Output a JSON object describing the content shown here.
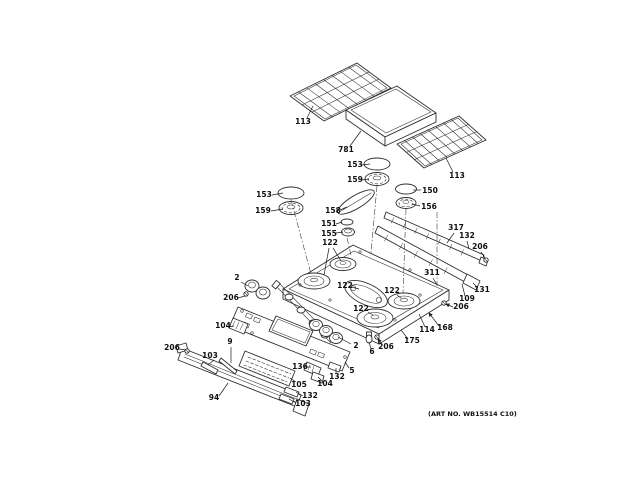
{
  "document": {
    "art_no": "(ART NO. WB15514 C10)",
    "background": "#ffffff",
    "line_color": "#2f2f2f",
    "label_color": "#101010"
  },
  "labels": [
    {
      "text": "113",
      "x": 303,
      "y": 124,
      "leaders": [
        [
          [
            307,
            118
          ],
          [
            313,
            106
          ]
        ]
      ]
    },
    {
      "text": "781",
      "x": 346,
      "y": 152,
      "leaders": [
        [
          [
            350,
            146
          ],
          [
            361,
            131
          ]
        ]
      ]
    },
    {
      "text": "113",
      "x": 457,
      "y": 178,
      "leaders": [
        [
          [
            453,
            172
          ],
          [
            446,
            158
          ]
        ]
      ]
    },
    {
      "text": "153",
      "x": 355,
      "y": 167,
      "leaders": [
        [
          [
            362,
            165
          ],
          [
            370,
            164
          ]
        ]
      ]
    },
    {
      "text": "159",
      "x": 355,
      "y": 182,
      "leaders": [
        [
          [
            362,
            180
          ],
          [
            369,
            179
          ]
        ]
      ]
    },
    {
      "text": "153",
      "x": 264,
      "y": 197,
      "leaders": [
        [
          [
            272,
            195
          ],
          [
            283,
            193
          ]
        ]
      ]
    },
    {
      "text": "159",
      "x": 263,
      "y": 213,
      "leaders": [
        [
          [
            271,
            211
          ],
          [
            283,
            209
          ]
        ]
      ]
    },
    {
      "text": "150",
      "x": 430,
      "y": 193,
      "leaders": [
        [
          [
            421,
            190
          ],
          [
            413,
            190
          ]
        ]
      ]
    },
    {
      "text": "156",
      "x": 429,
      "y": 209,
      "leaders": [
        [
          [
            420,
            206
          ],
          [
            412,
            204
          ]
        ]
      ]
    },
    {
      "text": "158",
      "x": 333,
      "y": 213,
      "leaders": [
        [
          [
            340,
            210
          ],
          [
            347,
            207
          ]
        ]
      ]
    },
    {
      "text": "151",
      "x": 329,
      "y": 226,
      "leaders": [
        [
          [
            336,
            224
          ],
          [
            342,
            222
          ]
        ]
      ]
    },
    {
      "text": "155",
      "x": 329,
      "y": 236,
      "leaders": [
        [
          [
            336,
            233
          ],
          [
            343,
            232
          ]
        ]
      ]
    },
    {
      "text": "122",
      "x": 330,
      "y": 245,
      "leaders": [
        [
          [
            333,
            248
          ],
          [
            341,
            261
          ]
        ],
        [
          [
            329,
            248
          ],
          [
            324,
            275
          ]
        ]
      ]
    },
    {
      "text": "317",
      "x": 456,
      "y": 230,
      "leaders": [
        [
          [
            454,
            233
          ],
          [
            447,
            243
          ]
        ]
      ]
    },
    {
      "text": "132",
      "x": 467,
      "y": 238,
      "leaders": [
        [
          [
            467,
            241
          ],
          [
            469,
            249
          ]
        ]
      ]
    },
    {
      "text": "206",
      "x": 480,
      "y": 249,
      "leaders": [
        [
          [
            481,
            252
          ],
          [
            485,
            258
          ]
        ]
      ]
    },
    {
      "text": "311",
      "x": 432,
      "y": 275,
      "leaders": [
        [
          [
            433,
            278
          ],
          [
            437,
            285
          ]
        ]
      ]
    },
    {
      "text": "131",
      "x": 482,
      "y": 292,
      "leaders": [
        [
          [
            478,
            288
          ],
          [
            473,
            283
          ]
        ]
      ]
    },
    {
      "text": "109",
      "x": 467,
      "y": 301,
      "leaders": [
        [
          [
            465,
            296
          ],
          [
            462,
            284
          ]
        ]
      ]
    },
    {
      "text": "206",
      "x": 461,
      "y": 309,
      "arrow": true,
      "leaders": [
        [
          [
            453,
            307
          ],
          [
            446,
            304
          ]
        ]
      ]
    },
    {
      "text": "168",
      "x": 445,
      "y": 330,
      "arrow": true,
      "leaders": [
        [
          [
            439,
            326
          ],
          [
            429,
            313
          ]
        ]
      ]
    },
    {
      "text": "114",
      "x": 427,
      "y": 332,
      "leaders": [
        [
          [
            425,
            327
          ],
          [
            419,
            314
          ]
        ]
      ]
    },
    {
      "text": "175",
      "x": 412,
      "y": 343,
      "leaders": [
        [
          [
            408,
            339
          ],
          [
            401,
            330
          ]
        ]
      ]
    },
    {
      "text": "122",
      "x": 345,
      "y": 288,
      "leaders": [
        [
          [
            352,
            287
          ],
          [
            359,
            289
          ]
        ]
      ]
    },
    {
      "text": "122",
      "x": 392,
      "y": 293,
      "leaders": [
        [
          [
            397,
            295
          ],
          [
            401,
            298
          ]
        ]
      ]
    },
    {
      "text": "122",
      "x": 361,
      "y": 311,
      "leaders": [
        [
          [
            368,
            312
          ],
          [
            373,
            315
          ]
        ]
      ]
    },
    {
      "text": "2",
      "x": 237,
      "y": 280,
      "leaders": [
        [
          [
            241,
            282
          ],
          [
            248,
            286
          ]
        ]
      ]
    },
    {
      "text": "206",
      "x": 231,
      "y": 300,
      "leaders": [
        [
          [
            238,
            298
          ],
          [
            245,
            296
          ]
        ]
      ]
    },
    {
      "text": "104",
      "x": 223,
      "y": 328,
      "leaders": [
        [
          [
            229,
            327
          ],
          [
            234,
            326
          ]
        ]
      ]
    },
    {
      "text": "9",
      "x": 230,
      "y": 344,
      "leaders": [
        [
          [
            231,
            347
          ],
          [
            231,
            363
          ]
        ]
      ]
    },
    {
      "text": "206",
      "x": 172,
      "y": 350,
      "leaders": [
        [
          [
            179,
            349
          ],
          [
            186,
            350
          ]
        ]
      ]
    },
    {
      "text": "103",
      "x": 210,
      "y": 358,
      "leaders": [
        [
          [
            214,
            360
          ],
          [
            208,
            365
          ]
        ]
      ]
    },
    {
      "text": "94",
      "x": 214,
      "y": 400,
      "leaders": [
        [
          [
            219,
            396
          ],
          [
            228,
            383
          ]
        ]
      ]
    },
    {
      "text": "136",
      "x": 300,
      "y": 369,
      "leaders": [
        [
          [
            306,
            367
          ],
          [
            311,
            367
          ]
        ]
      ]
    },
    {
      "text": "105",
      "x": 299,
      "y": 387,
      "leaders": [
        [
          [
            296,
            382
          ],
          [
            290,
            378
          ]
        ]
      ]
    },
    {
      "text": "104",
      "x": 325,
      "y": 386,
      "leaders": [
        [
          [
            322,
            381
          ],
          [
            318,
            377
          ]
        ]
      ]
    },
    {
      "text": "132",
      "x": 337,
      "y": 379,
      "leaders": [
        [
          [
            336,
            374
          ],
          [
            336,
            368
          ]
        ]
      ]
    },
    {
      "text": "5",
      "x": 352,
      "y": 373,
      "leaders": [
        [
          [
            349,
            368
          ],
          [
            345,
            362
          ]
        ]
      ]
    },
    {
      "text": "132",
      "x": 310,
      "y": 398,
      "leaders": [
        [
          [
            303,
            396
          ],
          [
            296,
            392
          ]
        ]
      ]
    },
    {
      "text": "103",
      "x": 303,
      "y": 406,
      "leaders": [
        [
          [
            296,
            403
          ],
          [
            289,
            399
          ]
        ]
      ]
    },
    {
      "text": "2",
      "x": 356,
      "y": 348,
      "leaders": [
        [
          [
            351,
            344
          ],
          [
            338,
            337
          ]
        ]
      ]
    },
    {
      "text": "6",
      "x": 372,
      "y": 354,
      "leaders": [
        [
          [
            371,
            349
          ],
          [
            369,
            342
          ]
        ]
      ]
    },
    {
      "text": "206",
      "x": 386,
      "y": 349,
      "arrow": true,
      "leaders": [
        [
          [
            382,
            345
          ],
          [
            378,
            339
          ]
        ]
      ]
    }
  ]
}
